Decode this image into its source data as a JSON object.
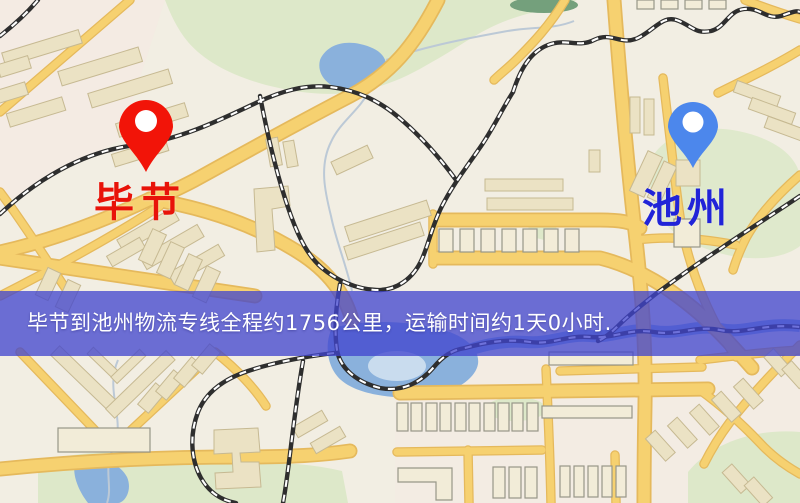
{
  "map_page": {
    "markers": {
      "origin": {
        "name": "毕节",
        "pin_color": "#f21408",
        "label_color": "#e81309"
      },
      "destination": {
        "name": "池州",
        "pin_color": "#4c87ec",
        "label_color": "#2124d8"
      }
    },
    "route_banner": {
      "text": "毕节到池州物流专线全程约1756公里，运输时间约1天0小时.",
      "background_color": "#4145cf",
      "text_color": "#ffffff"
    },
    "palette": {
      "background": "#f2eee3",
      "road_fill": "#f6d170",
      "road_casing": "#e5b95c",
      "water": "#8ab1dc",
      "water_light": "#c9dcee",
      "park": "#dde8c9",
      "park_dark": "#74a07c",
      "building": "#ebe2c4",
      "building_outline": "#c6b992",
      "railway_dark": "#2e2e2e",
      "railway_light": "#ffffff",
      "stream": "#bcc9d6"
    }
  }
}
